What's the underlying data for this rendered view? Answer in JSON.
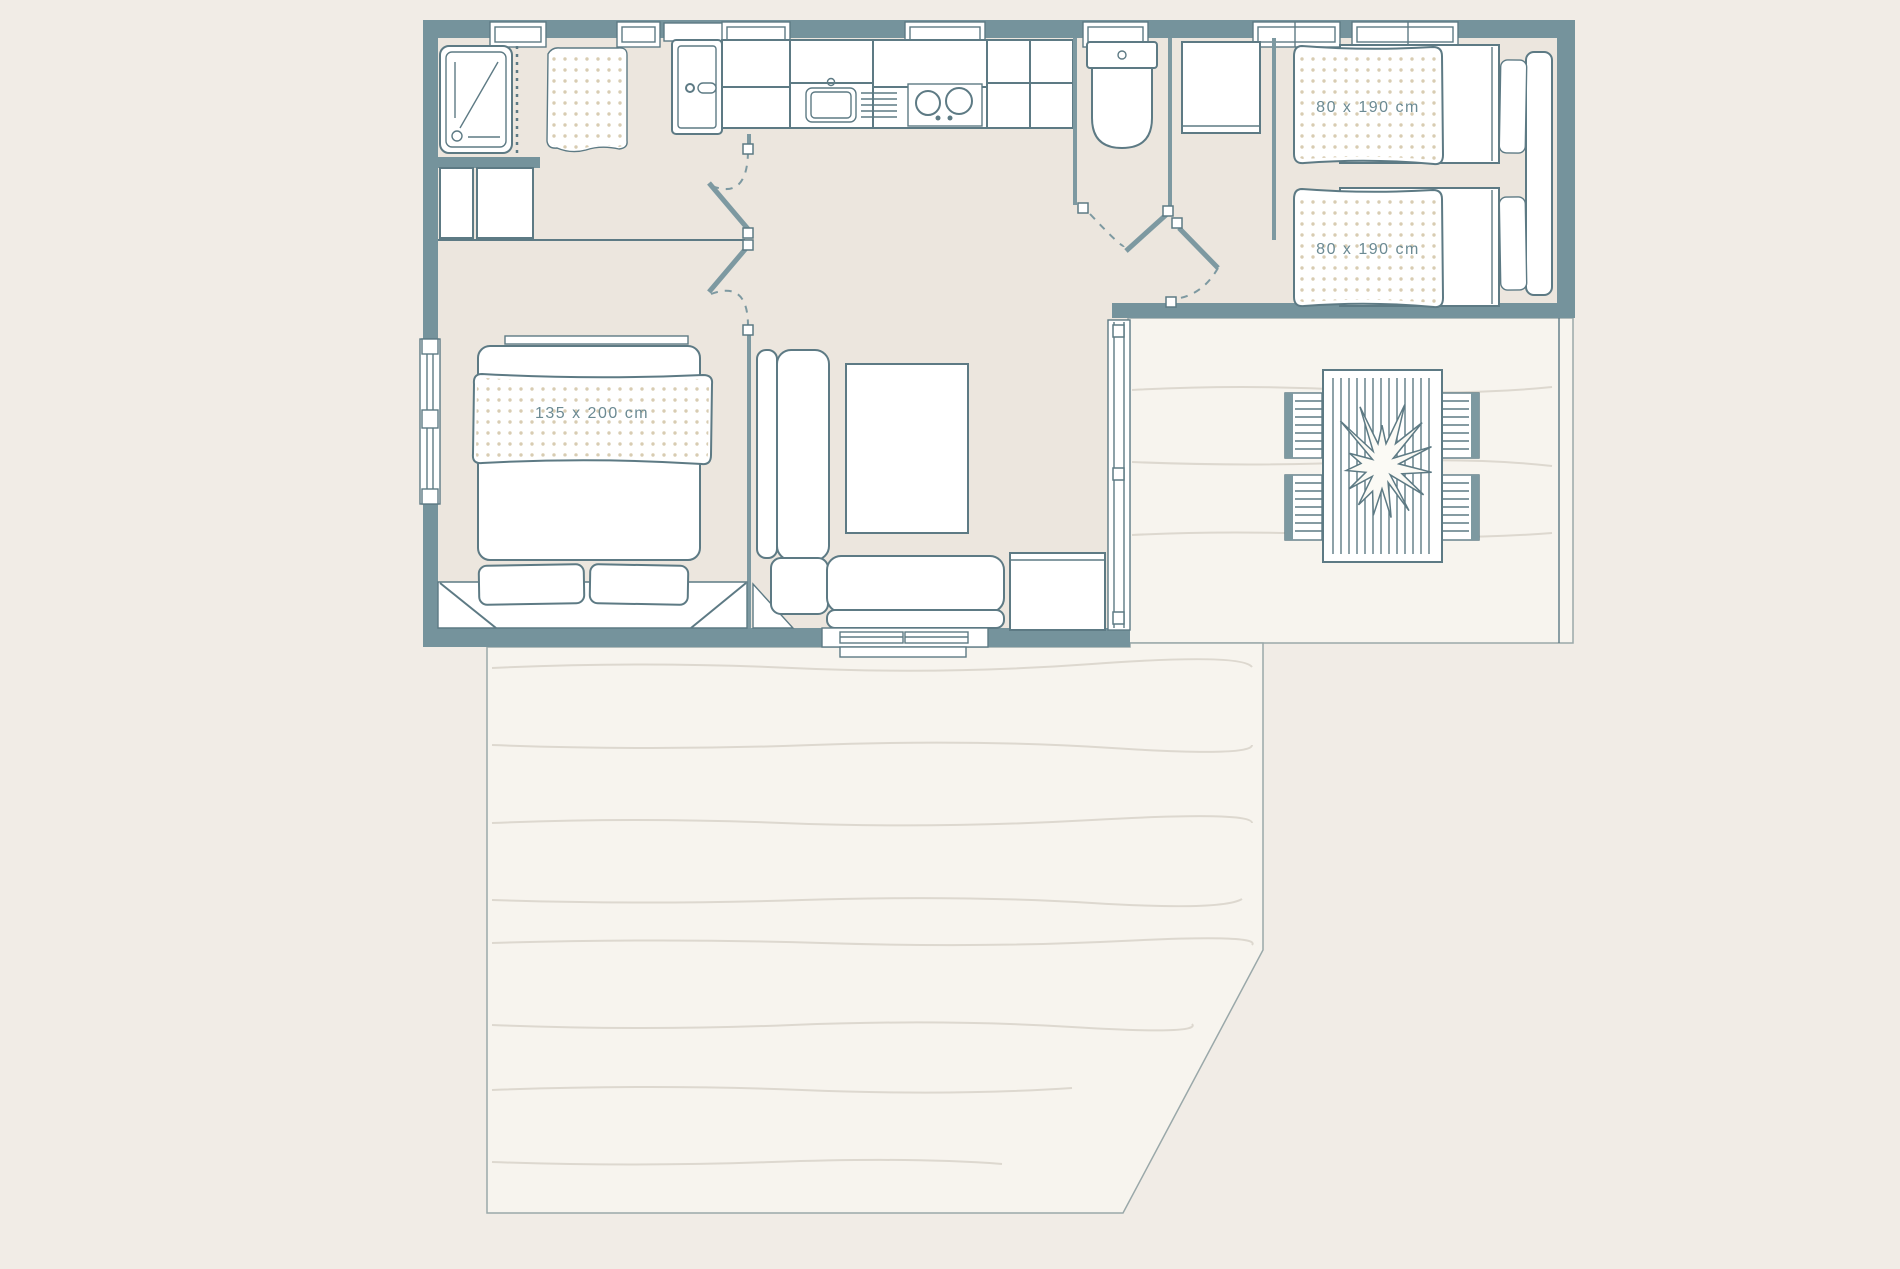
{
  "title": "mobile-home-floor-plan",
  "labels": {
    "double_bed_size": "135 x 200 cm",
    "twin_bed_1_size": "80 x 190 cm",
    "twin_bed_2_size": "80 x 190 cm"
  },
  "colors": {
    "outside_background": "#f1ece6",
    "interior_floor": "#ece6de",
    "terrace_floor": "#f7f4ee",
    "terrace_edge": "#9aa8a9",
    "wall": "#75939c",
    "wall_light": "#7d99a1",
    "outline": "#5d7a84",
    "plank_line": "#ddd8cf",
    "duvet_dots": "#d8ccb2",
    "label_text": "#6b8a93"
  },
  "rooms": [
    {
      "name": "shower-room"
    },
    {
      "name": "master-bedroom"
    },
    {
      "name": "kitchen"
    },
    {
      "name": "wc"
    },
    {
      "name": "twin-bedroom"
    },
    {
      "name": "living-room"
    },
    {
      "name": "side-terrace"
    },
    {
      "name": "main-terrace"
    }
  ]
}
